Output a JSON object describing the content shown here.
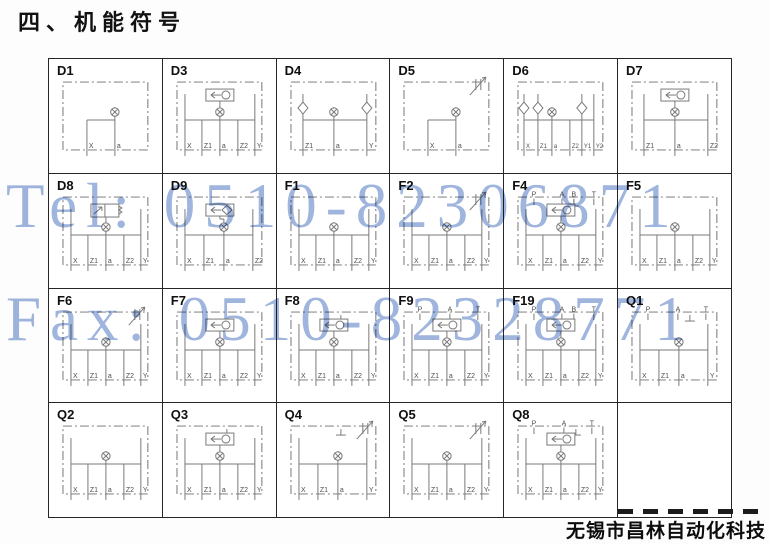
{
  "title": "四、机能符号",
  "watermarks": {
    "tel": "Tel: 0510-82306871",
    "fax": "Fax: 0510-82328771",
    "color": "#8aa5d6"
  },
  "footer": {
    "company": "无锡市昌林自动化科技"
  },
  "table": {
    "columns": 6,
    "rows": 4,
    "cells": [
      {
        "id": "D1",
        "top_ports": [],
        "bottom_ports": [
          "X",
          "a"
        ],
        "features": [
          "orifice"
        ]
      },
      {
        "id": "D3",
        "top_ports": [],
        "bottom_ports": [
          "X",
          "Z1",
          "a",
          "Z2",
          "Y"
        ],
        "features": [
          "shuttle-circle",
          "orifice"
        ]
      },
      {
        "id": "D4",
        "top_ports": [],
        "bottom_ports": [
          "Z1",
          "a",
          "Y"
        ],
        "features": [
          "check-left",
          "check-right",
          "orifice"
        ]
      },
      {
        "id": "D5",
        "top_ports": [],
        "bottom_ports": [
          "X",
          "a"
        ],
        "features": [
          "throttle",
          "orifice"
        ]
      },
      {
        "id": "D6",
        "top_ports": [],
        "bottom_ports": [
          "X",
          "Z1",
          "a",
          "Z2",
          "Y1",
          "Y2"
        ],
        "features": [
          "check-left",
          "check-left2",
          "check-right",
          "orifice"
        ]
      },
      {
        "id": "D7",
        "top_ports": [],
        "bottom_ports": [
          "Z1",
          "a",
          "Z2"
        ],
        "features": [
          "shuttle-circle",
          "orifice"
        ]
      },
      {
        "id": "D8",
        "top_ports": [],
        "bottom_ports": [
          "X",
          "Z1",
          "a",
          "Z2",
          "Y"
        ],
        "features": [
          "directional-valve",
          "orifice"
        ]
      },
      {
        "id": "D9",
        "top_ports": [],
        "bottom_ports": [
          "X",
          "Z1",
          "a",
          "Z2"
        ],
        "features": [
          "shuttle-diamond",
          "orifice"
        ]
      },
      {
        "id": "F1",
        "top_ports": [],
        "bottom_ports": [
          "X",
          "Z1",
          "a",
          "Z2",
          "Y"
        ],
        "features": [
          "orifice"
        ]
      },
      {
        "id": "F2",
        "top_ports": [],
        "bottom_ports": [
          "X",
          "Z1",
          "a",
          "Z2",
          "Y"
        ],
        "features": [
          "throttle",
          "orifice"
        ]
      },
      {
        "id": "F4",
        "top_ports": [
          "P",
          "A",
          "B",
          "T"
        ],
        "bottom_ports": [
          "X",
          "Z1",
          "a",
          "Z2",
          "Y"
        ],
        "features": [
          "shuttle-circle",
          "tank",
          "orifice"
        ]
      },
      {
        "id": "F5",
        "top_ports": [],
        "bottom_ports": [
          "X",
          "Z1",
          "a",
          "Z2",
          "Y"
        ],
        "features": [
          "orifice"
        ]
      },
      {
        "id": "F6",
        "top_ports": [],
        "bottom_ports": [
          "X",
          "Z1",
          "a",
          "Z2",
          "Y"
        ],
        "features": [
          "throttle",
          "orifice"
        ]
      },
      {
        "id": "F7",
        "top_ports": [],
        "bottom_ports": [
          "X",
          "Z1",
          "a",
          "Z2",
          "Y"
        ],
        "features": [
          "shuttle-circle",
          "orifice"
        ]
      },
      {
        "id": "F8",
        "top_ports": [],
        "bottom_ports": [
          "X",
          "Z1",
          "a",
          "Z2",
          "Y"
        ],
        "features": [
          "shuttle-circle",
          "tank",
          "orifice"
        ]
      },
      {
        "id": "F9",
        "top_ports": [
          "P",
          "A",
          "T"
        ],
        "bottom_ports": [
          "X",
          "Z1",
          "a",
          "Z2",
          "Y"
        ],
        "features": [
          "shuttle-circle",
          "orifice"
        ]
      },
      {
        "id": "F19",
        "top_ports": [
          "P",
          "A",
          "B",
          "T"
        ],
        "bottom_ports": [
          "X",
          "Z1",
          "a",
          "Z2",
          "Y"
        ],
        "features": [
          "shuttle-circle",
          "orifice"
        ]
      },
      {
        "id": "Q1",
        "top_ports": [
          "P",
          "A",
          "T"
        ],
        "bottom_ports": [
          "X",
          "Z1",
          "a",
          "Y"
        ],
        "features": [
          "tank",
          "orifice"
        ]
      },
      {
        "id": "Q2",
        "top_ports": [],
        "bottom_ports": [
          "X",
          "Z1",
          "a",
          "Z2",
          "Y"
        ],
        "features": [
          "orifice"
        ]
      },
      {
        "id": "Q3",
        "top_ports": [],
        "bottom_ports": [
          "X",
          "Z1",
          "a",
          "Z2",
          "Y"
        ],
        "features": [
          "shuttle-circle",
          "tank",
          "orifice"
        ]
      },
      {
        "id": "Q4",
        "top_ports": [],
        "bottom_ports": [
          "X",
          "Z1",
          "a",
          "Y"
        ],
        "features": [
          "throttle",
          "tank",
          "orifice"
        ]
      },
      {
        "id": "Q5",
        "top_ports": [],
        "bottom_ports": [
          "X",
          "Z1",
          "a",
          "Z2",
          "Y"
        ],
        "features": [
          "throttle",
          "orifice"
        ]
      },
      {
        "id": "Q8",
        "top_ports": [
          "P",
          "A",
          "T"
        ],
        "bottom_ports": [
          "X",
          "Z1",
          "a",
          "Z2",
          "Y"
        ],
        "features": [
          "shuttle-circle",
          "tank",
          "orifice"
        ]
      },
      {
        "id": "",
        "empty": true,
        "top_ports": [],
        "bottom_ports": [],
        "features": []
      }
    ]
  }
}
